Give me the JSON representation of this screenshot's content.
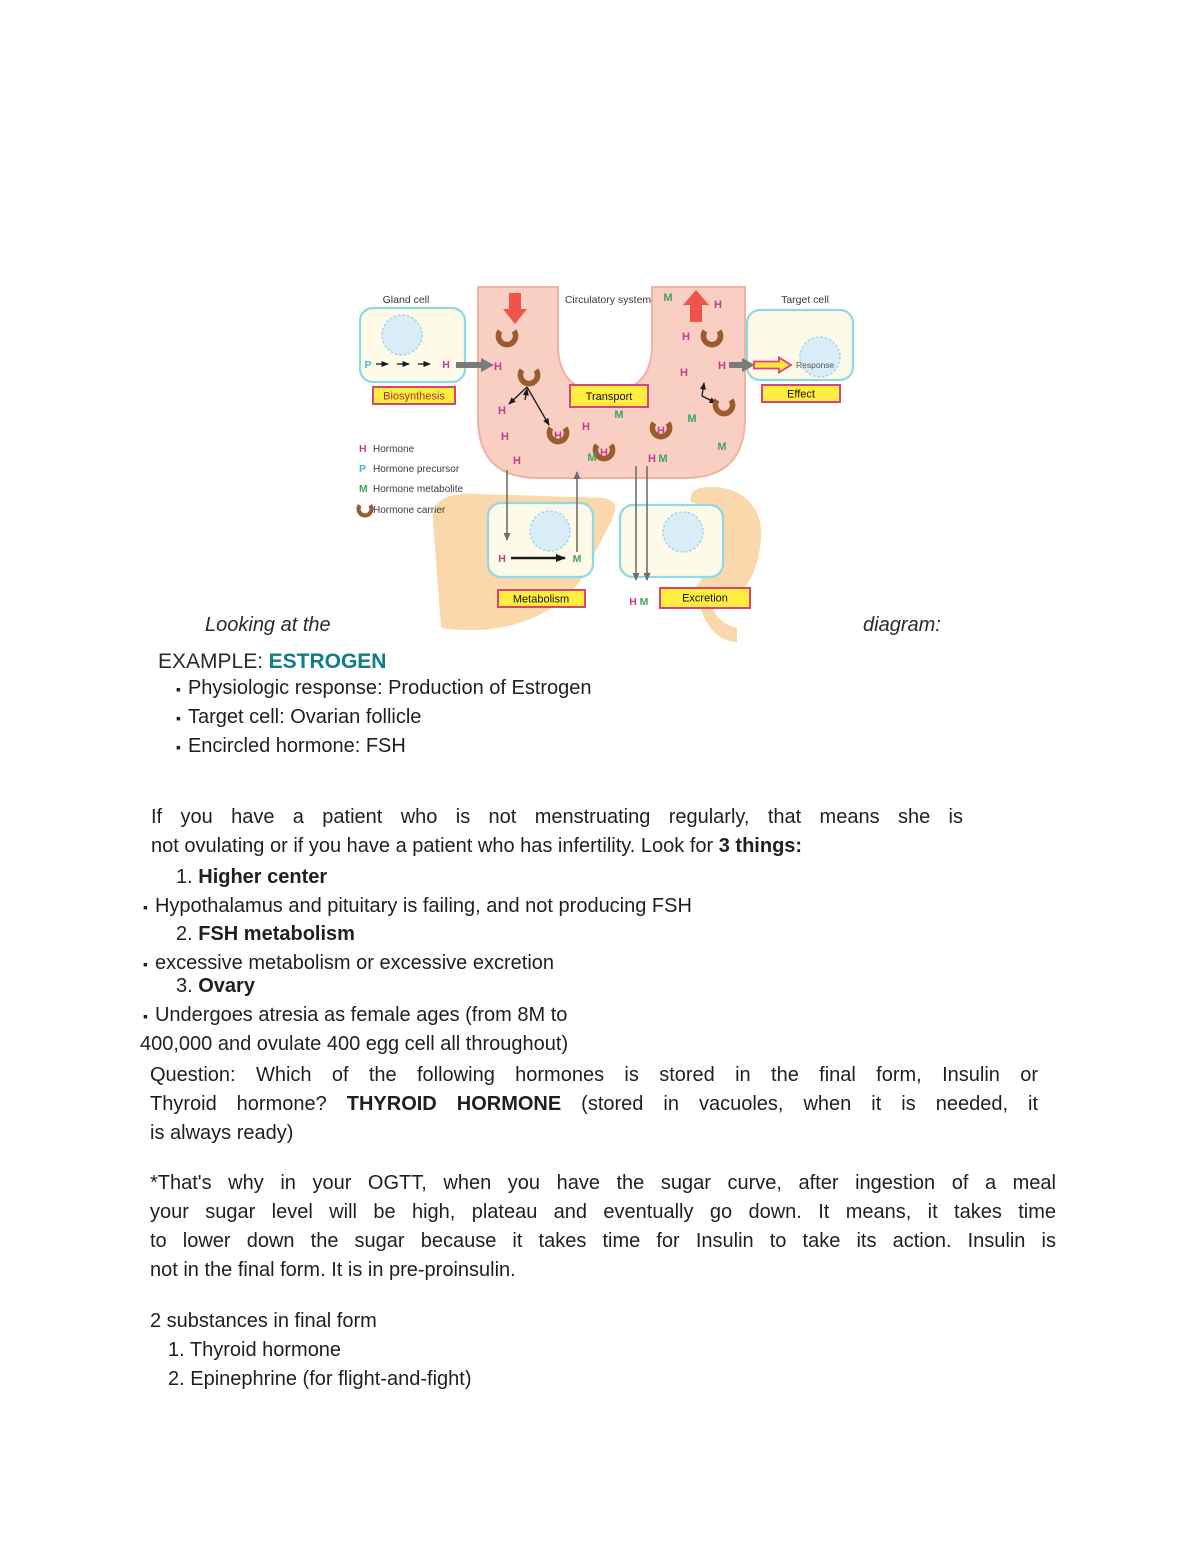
{
  "diagram": {
    "labels": {
      "gland_cell": "Gland cell",
      "circulatory_system": "Circulatory system",
      "target_cell": "Target cell",
      "biosynthesis": "Biosynthesis",
      "transport": "Transport",
      "effect": "Effect",
      "metabolism": "Metabolism",
      "excretion": "Excretion",
      "response": "Response",
      "hormone_letter": "H",
      "hormone_precursor_letter": "P",
      "metabolite_letter": "M"
    },
    "legend": [
      {
        "symbol": "H",
        "label": "Hormone"
      },
      {
        "symbol": "P",
        "label": "Hormone precursor"
      },
      {
        "symbol": "M",
        "label": "Hormone metabolite"
      },
      {
        "symbol": "hormone-carrier-icon",
        "label": "Hormone carrier"
      }
    ],
    "colors": {
      "hormone": "#c73b92",
      "precursor": "#3eb6d8",
      "metabolite": "#3da55e",
      "carrier": "#9a5b2f",
      "vessel": "#f8cfc2",
      "vessel_edge": "#f0b3a0",
      "label_box_fill": "#ffee3e",
      "label_box_border": "#d64575",
      "cell_fill": "#fdfbe8",
      "cell_border": "#8fd8e4",
      "nucleus_fill": "#d9edf8",
      "nucleus_border": "#a5d2e8",
      "organ": "#fad8ab",
      "flow_arrow": "#ee5449",
      "transfer_arrow": "#7a7a7a",
      "estrogen_teal": "#0e7d87"
    },
    "tube_letters": [
      {
        "t": "H",
        "x": 143,
        "y": 98,
        "c": "h"
      },
      {
        "t": "H",
        "x": 147,
        "y": 142,
        "c": "h"
      },
      {
        "t": "H",
        "x": 150,
        "y": 168,
        "c": "h"
      },
      {
        "t": "H",
        "x": 162,
        "y": 192,
        "c": "h"
      },
      {
        "t": "H",
        "x": 203,
        "y": 167,
        "c": "h"
      },
      {
        "t": "H",
        "x": 231,
        "y": 158,
        "c": "h"
      },
      {
        "t": "M",
        "x": 264,
        "y": 146,
        "c": "m"
      },
      {
        "t": "M",
        "x": 237,
        "y": 189,
        "c": "m"
      },
      {
        "t": "H",
        "x": 249,
        "y": 184,
        "c": "h"
      },
      {
        "t": "H",
        "x": 297,
        "y": 190,
        "c": "h"
      },
      {
        "t": "M",
        "x": 308,
        "y": 190,
        "c": "m"
      },
      {
        "t": "H",
        "x": 306,
        "y": 162,
        "c": "h"
      },
      {
        "t": "M",
        "x": 337,
        "y": 150,
        "c": "m"
      },
      {
        "t": "M",
        "x": 367,
        "y": 178,
        "c": "m"
      },
      {
        "t": "H",
        "x": 329,
        "y": 104,
        "c": "h"
      },
      {
        "t": "H",
        "x": 331,
        "y": 68,
        "c": "h"
      },
      {
        "t": "M",
        "x": 313,
        "y": 29,
        "c": "m"
      },
      {
        "t": "H",
        "x": 363,
        "y": 36,
        "c": "h"
      },
      {
        "t": "H",
        "x": 367,
        "y": 97,
        "c": "h"
      }
    ],
    "carriers": [
      {
        "x": 152,
        "y": 64
      },
      {
        "x": 174,
        "y": 103
      },
      {
        "x": 203,
        "y": 161
      },
      {
        "x": 249,
        "y": 178
      },
      {
        "x": 306,
        "y": 156
      },
      {
        "x": 357,
        "y": 64
      },
      {
        "x": 369,
        "y": 133
      }
    ]
  },
  "caption": {
    "left": "Looking at the",
    "right": "diagram:"
  },
  "bullet_char": "▪",
  "example": {
    "prefix": "EXAMPLE:",
    "name": "ESTROGEN",
    "bullets": [
      "Physiologic response: Production of Estrogen",
      "Target cell: Ovarian follicle",
      "Encircled hormone: FSH"
    ]
  },
  "notes": {
    "intro_line1": "If you have a patient who is not menstruating regularly, that means she is",
    "intro_line2_pre": "not ovulating or if you have a patient who has infertility. Look for ",
    "intro_line2_bold": "3 things:",
    "items": [
      {
        "num": "1.",
        "title": "Higher center",
        "detail": "Hypothalamus and pituitary is failing, and not producing FSH"
      },
      {
        "num": "2.",
        "title": "FSH metabolism",
        "detail": "excessive metabolism or excessive excretion"
      },
      {
        "num": "3.",
        "title": "Ovary",
        "detail": "Undergoes atresia as female ages (from 8M to",
        "detail2": "400,000 and ovulate 400 egg cell all throughout)"
      }
    ],
    "question": {
      "line1": "Question: Which of the following hormones is stored in the final form, Insulin or",
      "line2_pre": "Thyroid hormone? ",
      "line2_bold": "THYROID HORMONE",
      "line2_post": " (stored in vacuoles, when it is needed, it",
      "line3": "is always ready)"
    },
    "ogtt": {
      "line1": "*That's why in your OGTT, when you have the sugar curve, after ingestion of a meal",
      "line2": "your sugar level will be high, plateau and eventually go down. It means, it takes time",
      "line3": "to lower down the sugar because it takes time for Insulin to take its action. Insulin is",
      "line4": "not in the final form. It is in pre-proinsulin."
    },
    "final_form_title": "2 substances in final form",
    "final_form_items": [
      "1. Thyroid hormone",
      "2. Epinephrine (for flight-and-fight)"
    ]
  }
}
